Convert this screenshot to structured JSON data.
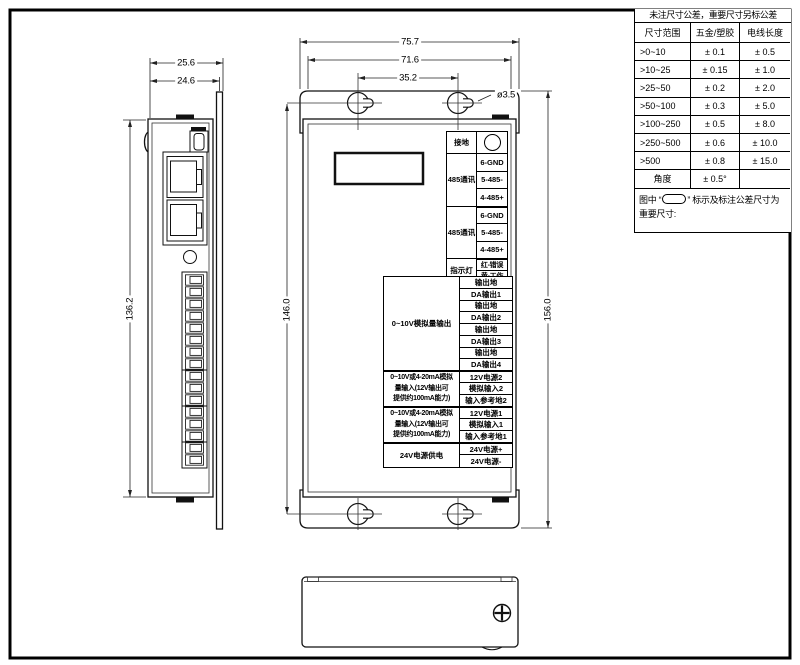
{
  "tol": {
    "title": "未注尺寸公差，重要尺寸另标公差",
    "headers": [
      "尺寸范围",
      "五金/塑胶",
      "电线长度"
    ],
    "rows": [
      {
        "range": ">0~10",
        "metal": "± 0.1",
        "wire": "± 0.5"
      },
      {
        "range": ">10~25",
        "metal": "± 0.15",
        "wire": "± 1.0"
      },
      {
        "range": ">25~50",
        "metal": "± 0.2",
        "wire": "± 2.0"
      },
      {
        "range": ">50~100",
        "metal": "± 0.3",
        "wire": "± 5.0"
      },
      {
        "range": ">100~250",
        "metal": "± 0.5",
        "wire": "± 8.0"
      },
      {
        "range": ">250~500",
        "metal": "± 0.6",
        "wire": "± 10.0"
      },
      {
        "range": ">500",
        "metal": "± 0.8",
        "wire": "± 15.0"
      },
      {
        "range": "角度",
        "metal": "± 0.5°",
        "wire": ""
      }
    ],
    "note_prefix": "图中 “",
    "note_suffix": "” 标示及标注公差尺寸为",
    "note_line2": "重要尺寸:"
  },
  "dims": {
    "width_overall": "75.7",
    "width_inner": "71.6",
    "hole_pitch_x": "35.2",
    "hole_dia": "ø3.5",
    "depth_overall": "25.6",
    "depth_body": "24.6",
    "side_height": "136.2",
    "hole_pitch_y": "146.0",
    "height_overall": "156.0"
  },
  "upper": {
    "groups": [
      {
        "label": "接地"
      },
      {
        "label": "485通讯",
        "pins": [
          "6-GND",
          "5-485-",
          "4-485+"
        ]
      },
      {
        "label": "485通讯",
        "pins": [
          "6-GND",
          "5-485-",
          "4-485+"
        ]
      },
      {
        "label": "指示灯",
        "pins": [
          "红-错误",
          "黄-工作"
        ]
      }
    ]
  },
  "lower": {
    "groups": [
      {
        "label": "0~10V模拟量输出",
        "pins": [
          "输出地",
          "DA输出1",
          "输出地",
          "DA输出2",
          "输出地",
          "DA输出3",
          "输出地",
          "DA输出4"
        ]
      },
      {
        "label_lines": [
          "0~10V或4-20mA模拟",
          "量输入(12V输出可",
          "提供约100mA能力)"
        ],
        "pins": [
          "12V电源2",
          "模拟输入2",
          "输入参考地2"
        ]
      },
      {
        "label_lines": [
          "0~10V或4-20mA模拟",
          "量输入(12V输出可",
          "提供约100mA能力)"
        ],
        "pins": [
          "12V电源1",
          "模拟输入1",
          "输入参考地1"
        ]
      },
      {
        "label": "24V电源供电",
        "pins": [
          "24V电源+",
          "24V电源-"
        ]
      }
    ]
  }
}
